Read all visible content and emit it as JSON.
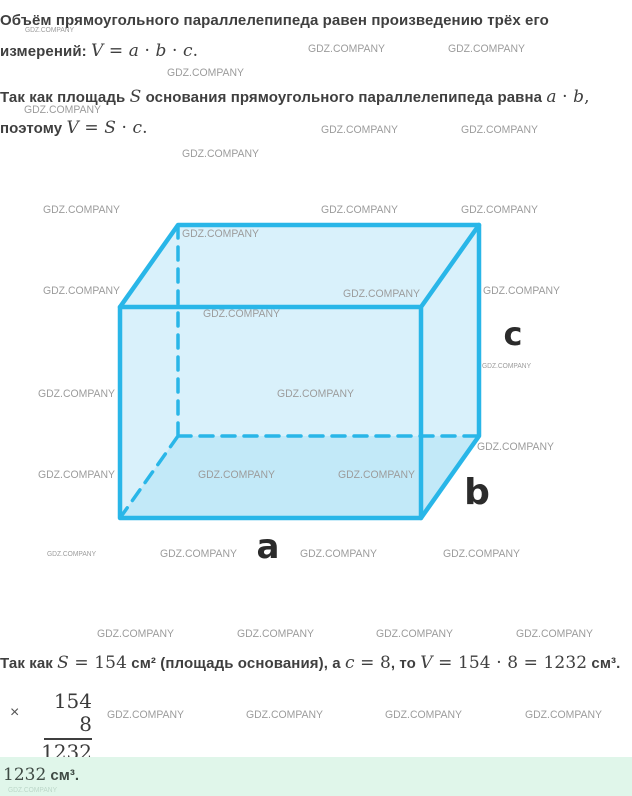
{
  "watermark": {
    "label": "GDZ.COMPANY"
  },
  "colors": {
    "accent_cyan": "#29b6e8",
    "figure_fill": "#d9f1fb",
    "answer_background": "#e0f6ea",
    "body_text": "#3f3f3f",
    "watermark_gray": "#9c9c9c"
  },
  "intro": {
    "p1": [
      {
        "s": "sans",
        "t": "Объём прямоугольного параллелепипеда равен произведению трёх его"
      }
    ],
    "p2": [
      {
        "s": "sans",
        "t": "измерений: "
      },
      {
        "s": "it",
        "t": "V"
      },
      {
        "s": "rm",
        "t": " = "
      },
      {
        "s": "it",
        "t": "a"
      },
      {
        "s": "rm",
        "t": " · "
      },
      {
        "s": "it",
        "t": "b"
      },
      {
        "s": "rm",
        "t": " · "
      },
      {
        "s": "it",
        "t": "c"
      },
      {
        "s": "rm",
        "t": "."
      }
    ],
    "p3": [
      {
        "s": "sans",
        "t": "Так как площадь "
      },
      {
        "s": "it",
        "t": "S"
      },
      {
        "s": "sans",
        "t": " основания прямоугольного параллелепипеда равна "
      },
      {
        "s": "it",
        "t": "a"
      },
      {
        "s": "rm",
        "t": " · "
      },
      {
        "s": "it",
        "t": "b"
      },
      {
        "s": "rm",
        "t": ","
      }
    ],
    "p4": [
      {
        "s": "sans",
        "t": "поэтому "
      },
      {
        "s": "it",
        "t": "V"
      },
      {
        "s": "rm",
        "t": " = "
      },
      {
        "s": "it",
        "t": "S"
      },
      {
        "s": "rm",
        "t": " · "
      },
      {
        "s": "it",
        "t": "c"
      },
      {
        "s": "rm",
        "t": "."
      }
    ]
  },
  "figure": {
    "labels": {
      "a": "a",
      "b": "b",
      "c": "c"
    }
  },
  "solution": {
    "p5": [
      {
        "s": "sans",
        "t": "Так как "
      },
      {
        "s": "it",
        "t": "S"
      },
      {
        "s": "rm",
        "t": " = 154"
      },
      {
        "s": "sans",
        "t": " см² (площадь основания), а "
      },
      {
        "s": "it",
        "t": "c"
      },
      {
        "s": "rm",
        "t": " = 8"
      },
      {
        "s": "sans",
        "t": ", то "
      },
      {
        "s": "it",
        "t": "V"
      },
      {
        "s": "rm",
        "t": " = 154 · 8 = 1232"
      },
      {
        "s": "sans",
        "t": " см³."
      }
    ],
    "multiplication": {
      "sign": "×",
      "multiplicand": "154",
      "multiplier": "8",
      "product": "1232"
    },
    "answer": [
      {
        "s": "rm",
        "t": "1232"
      },
      {
        "s": "sans",
        "t": " см³."
      }
    ]
  }
}
